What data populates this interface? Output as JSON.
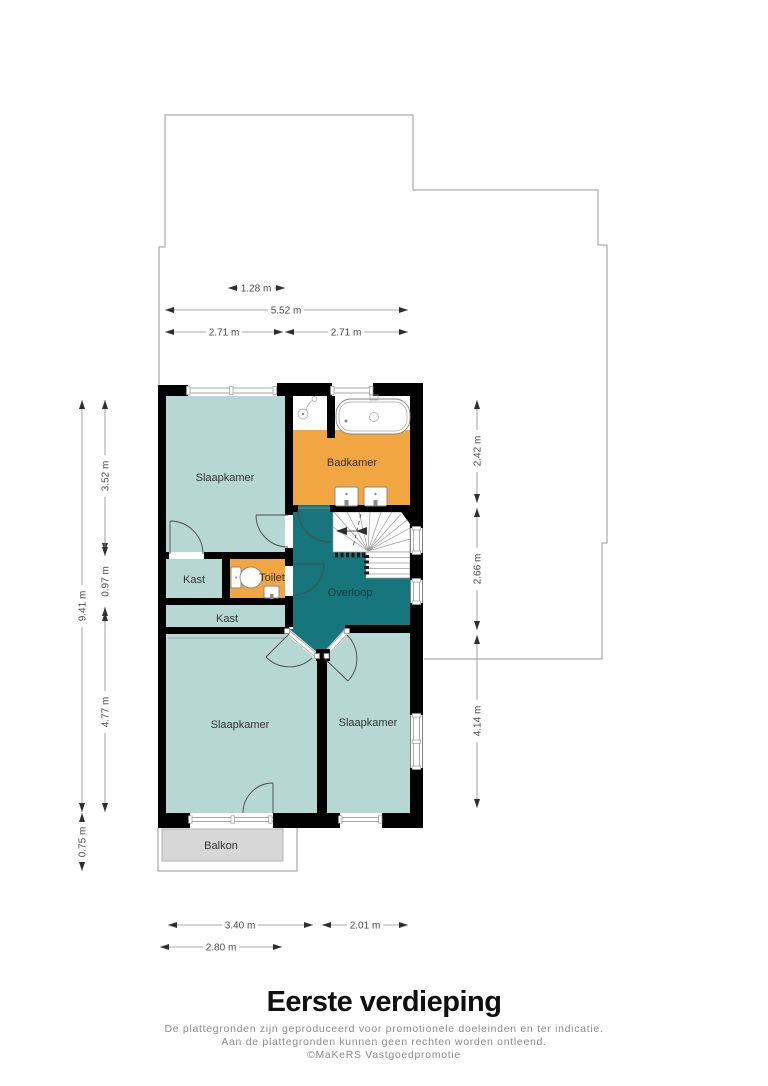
{
  "plan": {
    "rooms": {
      "slaapkamer_tl": "Slaapkamer",
      "badkamer": "Badkamer",
      "kast_left": "Kast",
      "toilet": "Toilet",
      "kast_wide": "Kast",
      "overloop": "Overloop",
      "slaapkamer_bl": "Slaapkamer",
      "slaapkamer_br": "Slaapkamer",
      "balkon": "Balkon"
    },
    "dimensions": {
      "top_window": "1.28 m",
      "top_total": "5.52 m",
      "top_left_half": "2.71 m",
      "top_right_half": "2.71 m",
      "left_total": "9.41 m",
      "left_upper": "3.52 m",
      "left_middle": "0.97 m",
      "left_lower": "4.77 m",
      "left_balcony": "0.75 m",
      "right_upper": "2.42 m",
      "right_middle": "2.66 m",
      "right_lower": "4.14 m",
      "bottom_left_room": "3.40 m",
      "bottom_right_room": "2.01 m",
      "bottom_balcony": "2.80 m"
    }
  },
  "footer": {
    "title": "Eerste verdieping",
    "disclaimer_line1": "De plattegronden zijn geproduceerd voor promotionele doeleinden en ter indicatie.",
    "disclaimer_line2": "Aan de plattegronden kunnen geen rechten worden ontleend.",
    "copyright": "©MaKeRS Vastgoedpromotie"
  },
  "colors": {
    "room": "#b7d7d2",
    "wet": "#f2a641",
    "landing": "#17767c",
    "wall": "#000000",
    "balcony": "#d7d7d7",
    "outline": "#9a9a9a",
    "dimension": "#4a4a4a",
    "label": "#333333",
    "disclaimer": "#8a8a8a"
  }
}
